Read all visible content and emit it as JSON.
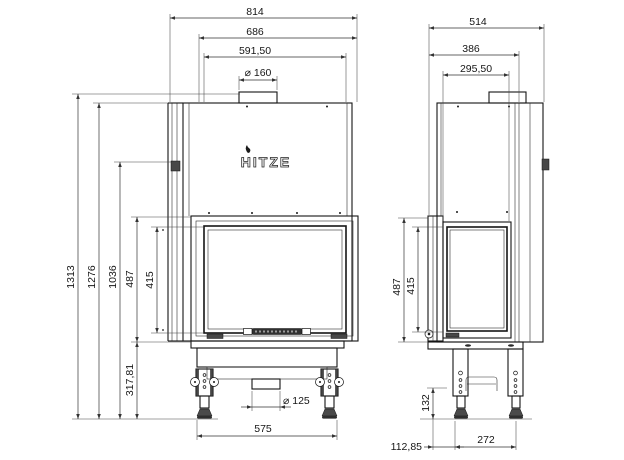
{
  "drawing": {
    "type": "technical-dimension-drawing",
    "product": "fireplace insert",
    "brand": {
      "logo_text": "HITZE"
    },
    "units": "mm",
    "line_color": "#151515",
    "background": "#ffffff"
  },
  "front_view": {
    "dims": {
      "total_width": "814",
      "body_width": "686",
      "glass_width": "591,50",
      "flue_diameter": "⌀ 160",
      "total_height": "1313",
      "body_height": "1276",
      "damper_height": "1036",
      "firebox_height": "487",
      "glass_height": "415",
      "base_height": "317,81",
      "air_inlet_diameter": "⌀ 125",
      "leg_spacing": "575"
    }
  },
  "side_view": {
    "dims": {
      "total_depth": "514",
      "body_depth": "386",
      "glass_depth": "295,50",
      "firebox_height": "487",
      "glass_height": "415",
      "foot_height": "132",
      "front_offset": "112,85",
      "leg_spacing": "272"
    }
  }
}
